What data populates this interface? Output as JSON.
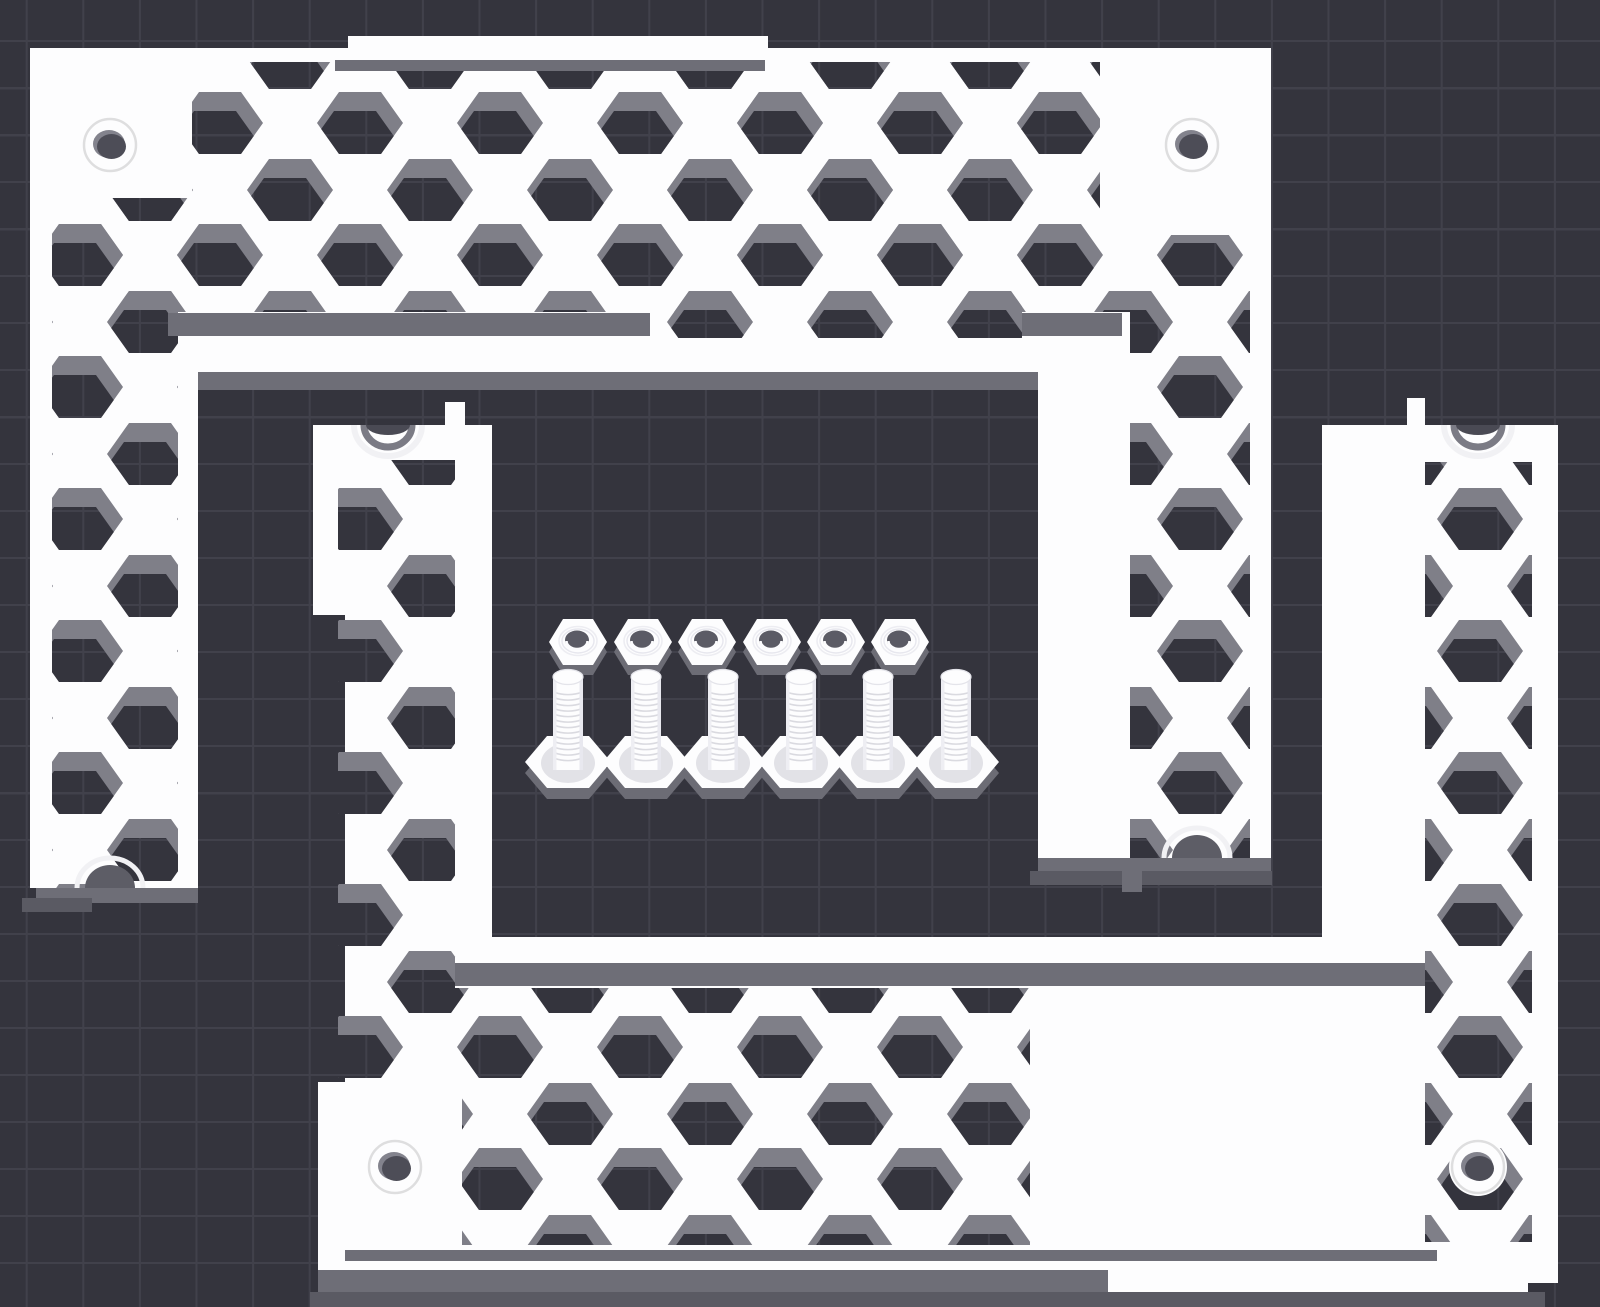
{
  "app": {
    "name": "3d-slicer-viewport",
    "description": "Dark build-plate scene with two white honeycomb-vented frame panels, six hex nuts and six hex bolts"
  },
  "canvas": {
    "width": 1600,
    "height": 1307
  },
  "colors": {
    "background": "#34343d",
    "grid_line": "#41414b",
    "part_white": "#fdfdfe",
    "hex_bevel": "#7f7f88",
    "wall_gray": "#6e6e77",
    "shadow_gray": "#5a5a63",
    "side_gray": "#6c6c75",
    "washer_gray": "#e2e2e7",
    "thread_line": "#d6d6dd",
    "hole_dark": "#4d4d57",
    "hole_wall": "#83838d",
    "notch_dark": "#5d5d66",
    "ring_light": "#f1f1f4",
    "nut_hole": "#5b5b65"
  },
  "grid": {
    "pitch_x": 56.6,
    "pitch_y": 47,
    "offset_x": 27.7,
    "offset_y": 42,
    "line_w": 2
  },
  "hex": {
    "origin_x": 10,
    "origin_y": 58,
    "pitch_x": 70,
    "pitch_y": 132,
    "row_offset": 65,
    "half_w": 43,
    "half_edge": 21,
    "half_h": 31,
    "bevel_dx": -5,
    "bevel_dy": 19
  },
  "parts": [
    {
      "id": "frame-top",
      "outline": "M30,48 H348 V36 H768 V48 H1271 V858 H1038 V372 H198 V888 H30 Z",
      "honeycomb_regions": [
        [
          52,
          62,
          1108,
          250
        ],
        [
          650,
          62,
          372,
          276
        ],
        [
          52,
          62,
          126,
          826
        ],
        [
          1130,
          235,
          120,
          623
        ]
      ],
      "patches": [
        [
          30,
          48,
          162,
          150
        ],
        [
          1100,
          48,
          171,
          187
        ]
      ],
      "strips": [
        {
          "r": [
            335,
            60,
            430,
            11
          ],
          "c": "wall_gray"
        },
        {
          "r": [
            168,
            313,
            482,
            23
          ],
          "c": "wall_gray"
        },
        {
          "r": [
            1022,
            313,
            100,
            23
          ],
          "c": "wall_gray"
        },
        {
          "r": [
            198,
            372,
            840,
            18
          ],
          "c": "wall_gray"
        },
        {
          "r": [
            36,
            888,
            162,
            15
          ],
          "c": "wall_gray"
        },
        {
          "r": [
            22,
            898,
            70,
            14
          ],
          "c": "shadow_gray"
        },
        {
          "r": [
            1038,
            858,
            233,
            15
          ],
          "c": "wall_gray"
        },
        {
          "r": [
            1030,
            871,
            242,
            14
          ],
          "c": "shadow_gray"
        },
        {
          "r": [
            1122,
            858,
            20,
            34
          ],
          "c": "wall_gray"
        }
      ],
      "notches": [
        {
          "x": 110,
          "y": 888,
          "dir": "up"
        },
        {
          "x": 1197,
          "y": 858,
          "dir": "up"
        }
      ],
      "screw_holes": [
        [
          110,
          145
        ],
        [
          1192,
          145
        ]
      ]
    },
    {
      "id": "frame-bottom",
      "outline": "M313,425 H445 V402 H465 V425 H492 V937 H1322 V425 H1407 V398 H1425 V425 H1558 V1283 H1528 V1292 H1108 V1270 H318 V1082 H345 V615 H313 Z",
      "honeycomb_regions": [
        [
          338,
          460,
          117,
          625
        ],
        [
          455,
          988,
          575,
          257
        ],
        [
          1425,
          462,
          107,
          780
        ]
      ],
      "patches": [
        [
          318,
          1082,
          144,
          188
        ]
      ],
      "strips": [
        {
          "r": [
            455,
            963,
            970,
            23
          ],
          "c": "wall_gray"
        },
        {
          "r": [
            345,
            1250,
            1092,
            11
          ],
          "c": "wall_gray"
        },
        {
          "r": [
            318,
            1270,
            790,
            22
          ],
          "c": "wall_gray"
        },
        {
          "r": [
            310,
            1292,
            1235,
            15
          ],
          "c": "shadow_gray"
        }
      ],
      "notches": [
        {
          "x": 388,
          "y": 425,
          "dir": "down"
        },
        {
          "x": 1478,
          "y": 425,
          "dir": "down"
        }
      ],
      "screw_holes": [
        [
          395,
          1167
        ],
        [
          1478,
          1167
        ]
      ]
    }
  ],
  "hardware": {
    "nuts": {
      "count": 6,
      "cx": [
        578,
        643,
        707,
        772,
        836,
        900
      ],
      "cy": 642,
      "radius": 29,
      "half_h": 23
    },
    "bolts": {
      "count": 6,
      "cx": [
        568,
        646,
        723,
        801,
        878,
        956
      ],
      "head_cy": 762,
      "head_radius": 43,
      "head_half_h": 26,
      "shaft_top": 676,
      "shaft_half_w": 15
    }
  }
}
